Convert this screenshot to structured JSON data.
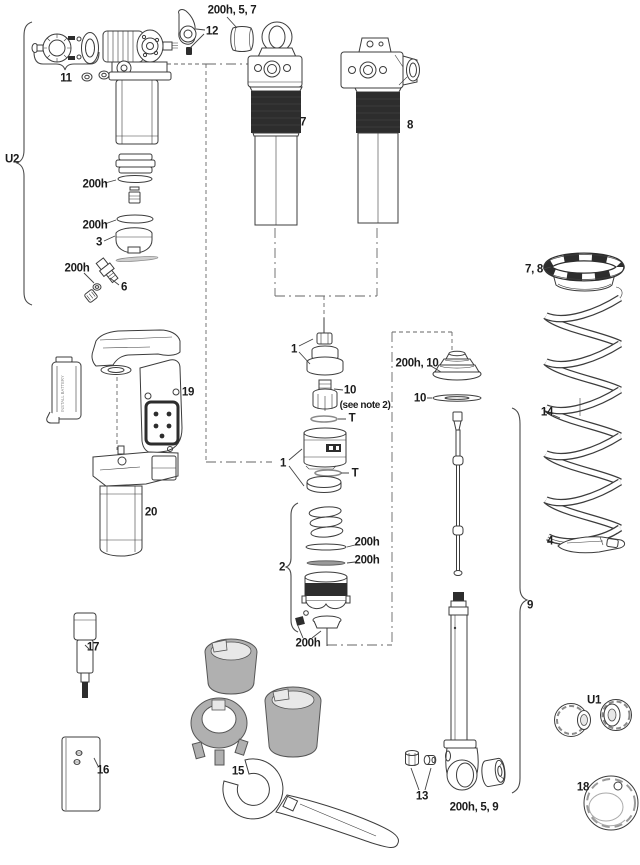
{
  "diagram": {
    "kind": "rear-shock-exploded-parts-diagram",
    "colors": {
      "line": "#3c3c3c",
      "dark": "#2d2d2d",
      "tool_grey": "#b0b0b0",
      "bg": "#ffffff"
    }
  },
  "labels": {
    "h200": "200h",
    "h200_5_7": "200h, 5, 7",
    "h200_10": "200h, 10",
    "h200_5_9": "200h, 5, 9",
    "see_note": "(see note 2)",
    "t": "T",
    "n1": "1",
    "n2": "2",
    "n3": "3",
    "n4": "4",
    "n6": "6",
    "n7": "7",
    "n7_8": "7, 8",
    "n8": "8",
    "n9": "9",
    "n10": "10",
    "n11": "11",
    "n12": "12",
    "n13": "13",
    "n14": "14",
    "n15": "15",
    "n16": "16",
    "n17": "17",
    "n18": "18",
    "n19": "19",
    "n20": "20",
    "u1": "U1",
    "u2": "U2",
    "battery_text": "INSTALL BATTERY"
  }
}
